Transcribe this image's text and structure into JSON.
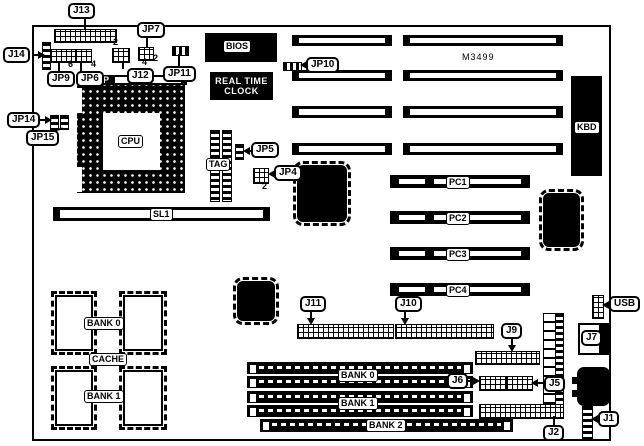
{
  "model": "M3499",
  "marker_p": "P",
  "callouts": {
    "j13": "J13",
    "jp7": "JP7",
    "j14": "J14",
    "jp9": "JP9",
    "jp6": "JP6",
    "j12": "J12",
    "jp11": "JP11",
    "jp14": "JP14",
    "jp15": "JP15",
    "jp10": "JP10",
    "jp5": "JP5",
    "jp4": "JP4",
    "j11": "J11",
    "j10": "J10",
    "j9": "J9",
    "j6": "J6",
    "j5": "J5",
    "j2": "J2",
    "j1": "J1",
    "usb": "USB",
    "j7": "J7"
  },
  "nums": {
    "j13": "2",
    "jp7": "2",
    "jp9": "6",
    "jp6": "4",
    "j12": "4",
    "jp4": "2"
  },
  "chips": {
    "cpu": "CPU",
    "tag": "TAG",
    "bios": "BIOS",
    "rtc1": "REAL TIME",
    "rtc2": "CLOCK",
    "kbd": "KBD",
    "sl1": "SL1",
    "pc1": "PC1",
    "pc2": "PC2",
    "pc3": "PC3",
    "pc4": "PC4",
    "cache0": "BANK 0",
    "cache": "CACHE",
    "cache1": "BANK 1",
    "bank0": "BANK 0",
    "bank1": "BANK 1",
    "bank2": "BANK 2"
  }
}
